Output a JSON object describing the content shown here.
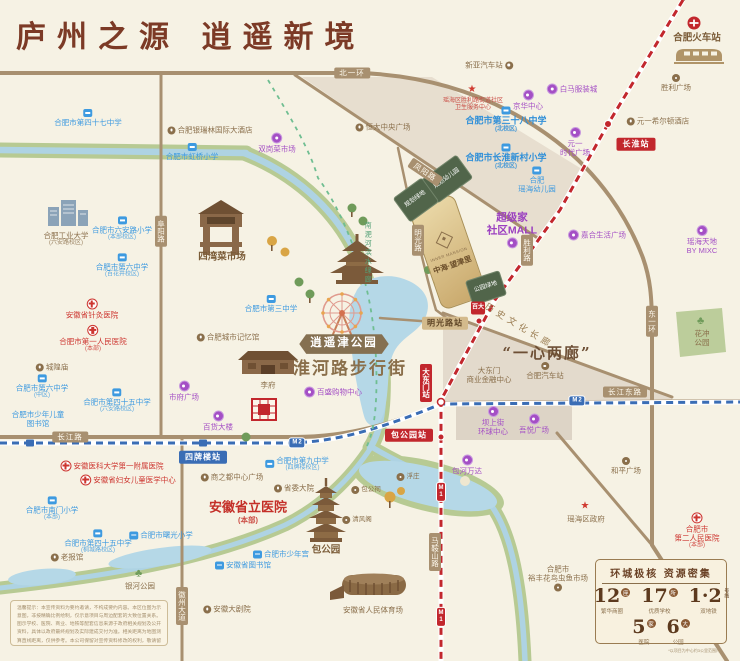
{
  "title": "庐州之源  逍遥新境",
  "project": {
    "logo_en": "INNER MANSION",
    "name": "中海·望津里"
  },
  "parcels": [
    {
      "label": "规划幼儿园"
    },
    {
      "label": "规划绿地"
    },
    {
      "label": "公园绿地"
    }
  ],
  "card": {
    "title": "环城极核 资源密集",
    "stats": [
      {
        "num": "12",
        "unit": "座",
        "label": "繁华商圈"
      },
      {
        "num": "17",
        "unit": "所",
        "label": "优质学校"
      },
      {
        "num": "1·2",
        "unit": "号线",
        "label": "双地铁"
      },
      {
        "num": "5",
        "unit": "家",
        "label": "医院"
      },
      {
        "num": "6",
        "unit": "大",
        "label": "公园"
      }
    ],
    "footnote": "*以项目为中心约3公里范围内"
  },
  "disclaimer": "温馨提示：本宣传资料为要约邀请，不构成要约内容。本区位图为示意图，非按精确比例绘制，仅示意项目与周边配套的大致位置关系。图示学校、医院、商业、地铁等配套信息来源于政府相关规划及公开资料，具体以政府最终规划及实际建成交付为准。相关距离为地图测算直线距离，仅供参考。本公司保留对宣传资料修改的权利，敬请留意最新资料。",
  "colors": {
    "accent_brown": "#7c3a26",
    "metro1": "#c2272d",
    "metro2": "#3a6db5",
    "school": "#3d9ae0",
    "hospital": "#cd3630",
    "commercial": "#a44fc5",
    "landmark": "#8a6f4b"
  },
  "pois": [
    {
      "id": "label-school-47",
      "type": "school",
      "icon": "book",
      "ipos": "top",
      "x": 88,
      "y": 118,
      "lines": [
        "合肥市第四十七中学"
      ]
    },
    {
      "id": "label-yinruilin-hotel",
      "type": "landmark",
      "icon": "spot",
      "ipos": "left",
      "x": 210,
      "y": 130,
      "lines": [
        "合肥银瑞林国际大酒店"
      ]
    },
    {
      "id": "label-hongqiao-primary",
      "type": "school",
      "icon": "book",
      "ipos": "top",
      "x": 192,
      "y": 152,
      "lines": [
        "合肥市虹桥小学"
      ]
    },
    {
      "id": "label-shuanggang-market",
      "type": "commercial",
      "icon": "shop",
      "ipos": "top",
      "x": 277,
      "y": 143,
      "lines": [
        "双岗菜市场"
      ]
    },
    {
      "id": "label-hengda-plaza",
      "type": "landmark",
      "icon": "spot",
      "ipos": "left",
      "x": 383,
      "y": 127,
      "lines": [
        "恒大中央广场"
      ]
    },
    {
      "id": "label-xinya-bus",
      "type": "landmark",
      "icon": "spot",
      "ipos": "right",
      "x": 489,
      "y": 65,
      "lines": [
        "新亚汽车站"
      ]
    },
    {
      "id": "label-baima-city",
      "type": "commercial",
      "icon": "shop",
      "ipos": "left",
      "x": 572,
      "y": 89,
      "lines": [
        "白马服装城"
      ]
    },
    {
      "id": "label-jinghua-center",
      "type": "commercial",
      "icon": "shop",
      "ipos": "top",
      "x": 528,
      "y": 100,
      "lines": [
        "京华中心"
      ]
    },
    {
      "id": "label-health-center",
      "type": "rednote",
      "icon": "star",
      "ipos": "top",
      "x": 473,
      "y": 99,
      "lines": [
        "瑶海区胜利路街道社区",
        "卫生服务中心"
      ]
    },
    {
      "id": "label-school-38",
      "type": "school-b",
      "icon": "book",
      "ipos": "top",
      "x": 506,
      "y": 120,
      "lines": [
        "合肥市第三十八中学"
      ],
      "sub": "(北校区)"
    },
    {
      "id": "label-changhuai-primary",
      "type": "school-b",
      "icon": "book",
      "ipos": "top",
      "x": 506,
      "y": 157,
      "lines": [
        "合肥市长淮新村小学"
      ],
      "sub": "(北校区)"
    },
    {
      "id": "label-yaohai-kindergarten",
      "type": "school",
      "icon": "book",
      "ipos": "top",
      "x": 537,
      "y": 180,
      "lines": [
        "合肥",
        "瑶海幼儿园"
      ]
    },
    {
      "id": "label-yuanyi-times",
      "type": "commercial",
      "icon": "shop",
      "ipos": "top",
      "x": 575,
      "y": 142,
      "lines": [
        "元一",
        "时代广场"
      ]
    },
    {
      "id": "label-hilton",
      "type": "landmark",
      "icon": "spot",
      "ipos": "left",
      "x": 658,
      "y": 121,
      "lines": [
        "元一希尔顿酒店"
      ]
    },
    {
      "id": "label-hefei-railway",
      "type": "landmark-b",
      "ipos": "top",
      "x": 697,
      "y": 38,
      "lines": [
        "合肥火车站"
      ]
    },
    {
      "id": "label-shengli-plaza",
      "type": "landmark",
      "icon": "spot",
      "ipos": "top",
      "x": 676,
      "y": 83,
      "lines": [
        "胜利广场"
      ]
    },
    {
      "id": "label-hfut",
      "type": "landmark",
      "ipos": "top",
      "x": 66,
      "y": 239,
      "lines": [
        "合肥工业大学"
      ],
      "sub": "(六安路校区)"
    },
    {
      "id": "label-luanlu-primary",
      "type": "school",
      "icon": "book",
      "ipos": "top",
      "x": 122,
      "y": 229,
      "lines": [
        "合肥市六安路小学"
      ],
      "sub": "(本部校区)"
    },
    {
      "id": "label-no6-middle",
      "type": "school",
      "icon": "book",
      "ipos": "top",
      "x": 122,
      "y": 266,
      "lines": [
        "合肥市第六中学"
      ],
      "sub": "(百花井校区)"
    },
    {
      "id": "label-zhenjiu-hospital",
      "type": "hospital",
      "icon": "cross",
      "ipos": "top",
      "x": 92,
      "y": 309,
      "lines": [
        "安徽省针灸医院"
      ]
    },
    {
      "id": "label-first-people-hospital",
      "type": "hospital",
      "icon": "cross",
      "ipos": "top",
      "x": 93,
      "y": 339,
      "lines": [
        "合肥市第一人民医院"
      ],
      "sub": "(本部)"
    },
    {
      "id": "label-chenghuangmiao",
      "type": "landmark",
      "icon": "spot",
      "ipos": "left",
      "x": 52,
      "y": 367,
      "lines": [
        "城隍庙"
      ]
    },
    {
      "id": "label-city-memory",
      "type": "landmark",
      "icon": "spot",
      "ipos": "left",
      "x": 228,
      "y": 337,
      "lines": [
        "合肥城市记忆馆"
      ]
    },
    {
      "id": "label-siwan-market",
      "type": "landmark-b",
      "ipos": "top",
      "x": 222,
      "y": 257,
      "lines": [
        "四湾菜市场"
      ]
    },
    {
      "id": "label-school-3",
      "type": "school",
      "icon": "book",
      "ipos": "top",
      "x": 271,
      "y": 304,
      "lines": [
        "合肥市第三中学"
      ]
    },
    {
      "id": "label-no6-middle-central",
      "type": "school",
      "icon": "book",
      "ipos": "top",
      "x": 42,
      "y": 387,
      "lines": [
        "合肥市第六中学"
      ],
      "sub": "(中区)"
    },
    {
      "id": "label-children-library",
      "type": "school",
      "ipos": "top",
      "x": 38,
      "y": 419,
      "lines": [
        "合肥市少年儿童",
        "图书馆"
      ]
    },
    {
      "id": "label-school-45a",
      "type": "school",
      "icon": "book",
      "ipos": "top",
      "x": 117,
      "y": 401,
      "lines": [
        "合肥市第四十五中学"
      ],
      "sub": "(六安路校区)"
    },
    {
      "id": "label-shifu-plaza",
      "type": "commercial",
      "icon": "shop",
      "ipos": "top",
      "x": 184,
      "y": 391,
      "lines": [
        "市府广场"
      ]
    },
    {
      "id": "label-baihuo-building",
      "type": "commercial",
      "icon": "shop",
      "ipos": "top",
      "x": 218,
      "y": 421,
      "lines": [
        "百货大楼"
      ]
    },
    {
      "id": "label-lifu",
      "type": "landmark",
      "ipos": "top",
      "x": 268,
      "y": 385,
      "lines": [
        "李府"
      ]
    },
    {
      "id": "label-parkson",
      "type": "commercial",
      "icon": "shop",
      "ipos": "left",
      "x": 333,
      "y": 392,
      "lines": [
        "百盛购物中心"
      ]
    },
    {
      "id": "label-anyi-hospital",
      "type": "hospital",
      "icon": "cross",
      "ipos": "left",
      "x": 112,
      "y": 466,
      "lines": [
        "安徽医科大学第一附属医院"
      ]
    },
    {
      "id": "label-women-children-center",
      "type": "hospital",
      "icon": "cross",
      "ipos": "left",
      "x": 128,
      "y": 480,
      "lines": [
        "安徽省妇女儿童医学中心"
      ]
    },
    {
      "id": "label-nanmen-primary",
      "type": "school",
      "icon": "book",
      "ipos": "top",
      "x": 52,
      "y": 509,
      "lines": [
        "合肥市南门小学"
      ],
      "sub": "(本部)"
    },
    {
      "id": "label-school-45b",
      "type": "school",
      "icon": "book",
      "ipos": "top",
      "x": 98,
      "y": 542,
      "lines": [
        "合肥市第四十五中学"
      ],
      "sub": "(桐城路校区)"
    },
    {
      "id": "label-shuguang-primary",
      "type": "school",
      "icon": "book",
      "ipos": "left",
      "x": 161,
      "y": 535,
      "lines": [
        "合肥市曙光小学"
      ]
    },
    {
      "id": "label-provincial-hospital",
      "type": "hospital-big",
      "ipos": "top",
      "x": 248,
      "y": 512,
      "lines": [
        "安徽省立医院"
      ],
      "sub": "(本部)"
    },
    {
      "id": "label-shangzhidu",
      "type": "landmark",
      "icon": "spot",
      "ipos": "left",
      "x": 232,
      "y": 477,
      "lines": [
        "商之都中心广场"
      ]
    },
    {
      "id": "label-school-9",
      "type": "school",
      "icon": "book",
      "ipos": "left",
      "x": 297,
      "y": 464,
      "lines": [
        "合肥市第九中学"
      ],
      "sub": "(四牌楼校区)"
    },
    {
      "id": "label-shengwei",
      "type": "landmark",
      "icon": "spot",
      "ipos": "left",
      "x": 294,
      "y": 488,
      "lines": [
        "省委大院"
      ]
    },
    {
      "id": "label-laobaoguan",
      "type": "landmark",
      "icon": "spot",
      "ipos": "left",
      "x": 67,
      "y": 557,
      "lines": [
        "老报馆"
      ]
    },
    {
      "id": "label-youth-palace",
      "type": "school",
      "icon": "book",
      "ipos": "left",
      "x": 281,
      "y": 554,
      "lines": [
        "合肥市少年宫"
      ]
    },
    {
      "id": "label-provincial-library",
      "type": "school",
      "icon": "book",
      "ipos": "left",
      "x": 243,
      "y": 565,
      "lines": [
        "安徽省图书馆"
      ]
    },
    {
      "id": "label-yinhe-park",
      "type": "landmark",
      "icon": "tree",
      "ipos": "top",
      "x": 140,
      "y": 580,
      "lines": [
        "银河公园"
      ]
    },
    {
      "id": "label-baogongyuan",
      "type": "landmark-b",
      "ipos": "top",
      "x": 326,
      "y": 550,
      "lines": [
        "包公园"
      ]
    },
    {
      "id": "label-fuzhuang",
      "type": "landmark-sm",
      "icon": "spot",
      "ipos": "left",
      "x": 408,
      "y": 477,
      "lines": [
        "浮庄"
      ]
    },
    {
      "id": "label-baogongci",
      "type": "landmark-sm",
      "icon": "spot",
      "ipos": "left",
      "x": 366,
      "y": 490,
      "lines": [
        "包公祠"
      ]
    },
    {
      "id": "label-qingfengge",
      "type": "landmark-sm",
      "icon": "spot",
      "ipos": "left",
      "x": 357,
      "y": 520,
      "lines": [
        "清风阁"
      ]
    },
    {
      "id": "label-grand-theater",
      "type": "landmark",
      "icon": "spot",
      "ipos": "left",
      "x": 227,
      "y": 609,
      "lines": [
        "安徽大剧院"
      ]
    },
    {
      "id": "label-stadium",
      "type": "landmark",
      "ipos": "top",
      "x": 373,
      "y": 610,
      "lines": [
        "安徽省人民体育场"
      ]
    },
    {
      "id": "label-baohe-wanda",
      "type": "commercial",
      "icon": "shop",
      "ipos": "top",
      "x": 467,
      "y": 465,
      "lines": [
        "包河万达"
      ]
    },
    {
      "id": "label-heping-plaza",
      "type": "landmark",
      "icon": "spot",
      "ipos": "top",
      "x": 626,
      "y": 466,
      "lines": [
        "和平广场"
      ]
    },
    {
      "id": "label-yaohai-gov",
      "type": "gov",
      "icon": "star",
      "ipos": "top",
      "x": 586,
      "y": 513,
      "lines": [
        "瑶海区政府"
      ]
    },
    {
      "id": "label-second-people-hospital",
      "type": "hospital",
      "icon": "cross",
      "ipos": "top",
      "x": 697,
      "y": 531,
      "lines": [
        "合肥市",
        "第二人民医院"
      ],
      "sub": "(本部)"
    },
    {
      "id": "label-yufeng-market",
      "type": "landmark",
      "icon": "spot",
      "ipos": "bottom",
      "x": 558,
      "y": 578,
      "lines": [
        "合肥市",
        "裕丰花鸟虫鱼市场"
      ]
    },
    {
      "id": "label-huachong-park",
      "type": "landmark",
      "icon": "tree",
      "ipos": "top",
      "x": 702,
      "y": 332,
      "lines": [
        "花冲",
        "公园"
      ]
    },
    {
      "id": "label-superhome-mall",
      "type": "commercial-b",
      "icon": "shop",
      "ipos": "bottom",
      "x": 512,
      "y": 230,
      "lines": [
        "超级家",
        "社区MALL"
      ]
    },
    {
      "id": "label-jiahe-plaza",
      "type": "commercial",
      "icon": "shop",
      "ipos": "left",
      "x": 597,
      "y": 235,
      "lines": [
        "嘉合生活广场"
      ]
    },
    {
      "id": "label-mixc",
      "type": "commercial",
      "icon": "shop",
      "ipos": "top",
      "x": 702,
      "y": 240,
      "lines": [
        "瑶海天地",
        "BY MIXC"
      ]
    },
    {
      "id": "label-bashangjie",
      "type": "commercial",
      "icon": "shop",
      "ipos": "top",
      "x": 493,
      "y": 421,
      "lines": [
        "坝上街",
        "环球中心"
      ]
    },
    {
      "id": "label-wuyue-plaza",
      "type": "commercial",
      "icon": "shop",
      "ipos": "top",
      "x": 534,
      "y": 424,
      "lines": [
        "吾悦广场"
      ]
    },
    {
      "id": "label-dadongmen-finance",
      "type": "landmark",
      "ipos": "top",
      "x": 489,
      "y": 375,
      "lines": [
        "大东门",
        "商业金融中心"
      ]
    },
    {
      "id": "label-hefei-bus",
      "type": "landmark",
      "icon": "spot",
      "ipos": "top",
      "x": 545,
      "y": 371,
      "lines": [
        "合肥汽车站"
      ]
    },
    {
      "id": "label-yixin-lianglang",
      "type": "big-brown",
      "x": 547,
      "y": 353,
      "lines": [
        "“一心两廊”"
      ]
    },
    {
      "id": "label-huaihe-road",
      "type": "big-brown-xl",
      "x": 350,
      "y": 369,
      "lines": [
        "淮河路步行街"
      ]
    },
    {
      "id": "label-xiaoyaojin-park",
      "type": "ribbon",
      "x": 344,
      "y": 344,
      "lines": [
        "逍遥津公园"
      ]
    },
    {
      "id": "label-history-corridor",
      "type": "gold-rot",
      "x": 519,
      "y": 326,
      "rot": 31,
      "lines": [
        "历史文化长廊"
      ]
    },
    {
      "id": "label-riverside-corridor",
      "type": "green-vert",
      "x": 367,
      "y": 253,
      "lines": [
        "南淝河滨水绿廊"
      ]
    },
    {
      "id": "baida-logo",
      "type": "logo-red",
      "x": 478,
      "y": 308,
      "lines": [
        "百大"
      ]
    },
    {
      "id": "road-beiyihuan",
      "type": "road",
      "x": 352,
      "y": 73,
      "lines": [
        "北一环"
      ]
    },
    {
      "id": "road-fuyanglu",
      "type": "road-v",
      "x": 161,
      "y": 231,
      "lines": [
        "阜阳路"
      ]
    },
    {
      "id": "road-changjianglu",
      "type": "road",
      "x": 70,
      "y": 437,
      "lines": [
        "长江路"
      ]
    },
    {
      "id": "road-changjiangdonglu",
      "type": "road",
      "x": 625,
      "y": 392,
      "lines": [
        "长江东路"
      ]
    },
    {
      "id": "road-huizhoudadao",
      "type": "road-v",
      "x": 182,
      "y": 606,
      "lines": [
        "徽州大道"
      ]
    },
    {
      "id": "road-maanshanlu",
      "type": "road-v",
      "x": 435,
      "y": 552,
      "lines": [
        "马鞍山路"
      ]
    },
    {
      "id": "road-dongyihuan",
      "type": "road-v",
      "x": 652,
      "y": 321,
      "lines": [
        "东一环"
      ]
    },
    {
      "id": "road-shenglilu",
      "type": "road-v",
      "x": 527,
      "y": 250,
      "lines": [
        "胜利路"
      ]
    },
    {
      "id": "road-mingguanglu",
      "type": "road-v",
      "x": 418,
      "y": 240,
      "lines": [
        "明光路"
      ]
    },
    {
      "id": "road-fengyanglu",
      "type": "road",
      "x": 425,
      "y": 172,
      "rot": 34,
      "lines": [
        "凤阳路"
      ]
    },
    {
      "id": "station-changhuai",
      "type": "st-red",
      "x": 636,
      "y": 144,
      "lines": [
        "长淮站"
      ]
    },
    {
      "id": "station-mingguanglu",
      "type": "st-tan",
      "x": 445,
      "y": 323,
      "lines": [
        "明光路站"
      ]
    },
    {
      "id": "station-dadongmen",
      "type": "st-red-v",
      "x": 426,
      "y": 383,
      "lines": [
        "大东门站"
      ]
    },
    {
      "id": "station-baogongyuan",
      "type": "st-red",
      "x": 409,
      "y": 435,
      "lines": [
        "包公园站"
      ]
    },
    {
      "id": "station-sipailou",
      "type": "st-blue",
      "x": 203,
      "y": 457,
      "lines": [
        "四牌楼站"
      ]
    },
    {
      "id": "metro2-badge-west",
      "type": "badge2",
      "x": 297,
      "y": 443,
      "lines": [
        "M",
        "2"
      ]
    },
    {
      "id": "metro2-badge-east",
      "type": "badge2",
      "x": 577,
      "y": 401,
      "lines": [
        "M",
        "2"
      ]
    },
    {
      "id": "metro1-badge-north",
      "type": "badge1",
      "x": 441,
      "y": 492,
      "lines": [
        "M",
        "1"
      ]
    },
    {
      "id": "metro1-badge-south",
      "type": "badge1",
      "x": 441,
      "y": 617,
      "lines": [
        "M",
        "1"
      ]
    }
  ]
}
